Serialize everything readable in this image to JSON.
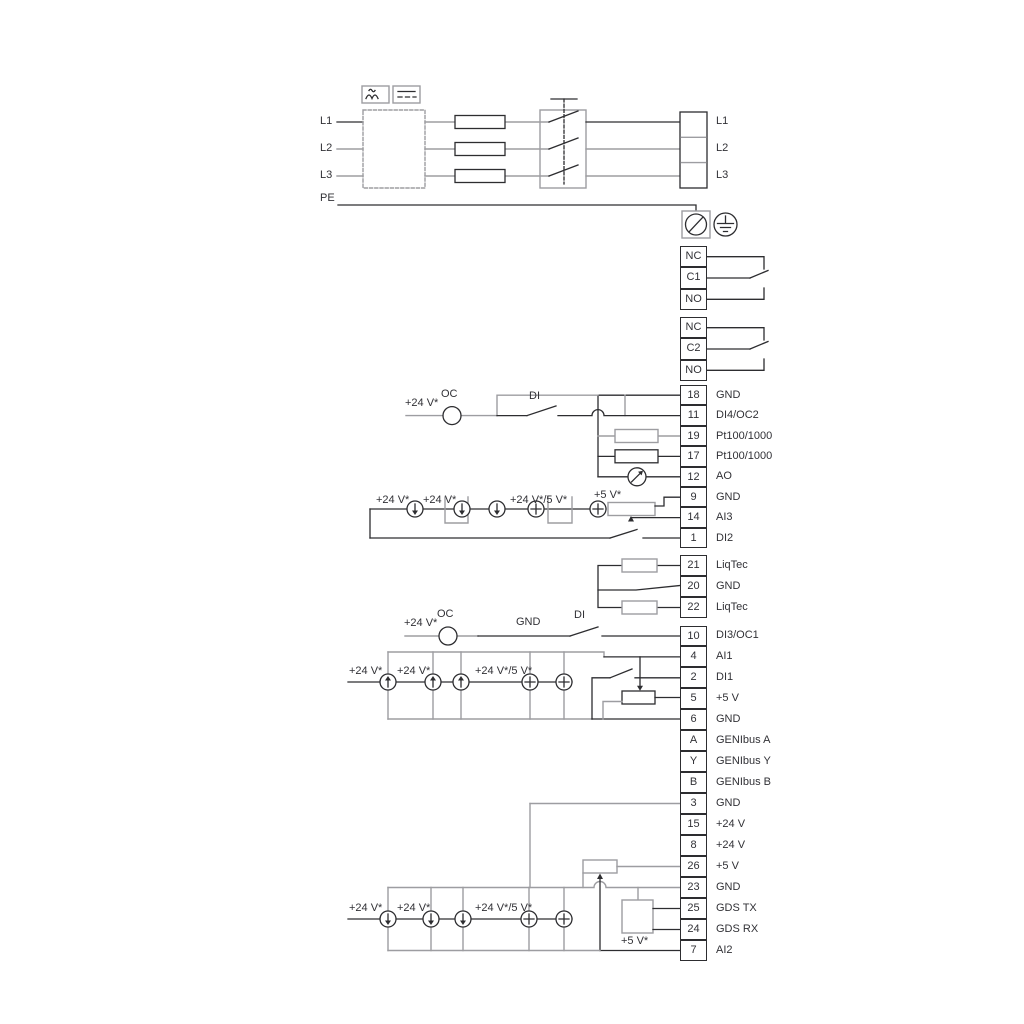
{
  "colors": {
    "line": "#2d2d30",
    "gray": "#9d9da1",
    "text": "#313136",
    "background": "#ffffff"
  },
  "mains": {
    "left": [
      "L1",
      "L2",
      "L3",
      "PE"
    ],
    "right": [
      "L1",
      "L2",
      "L3"
    ]
  },
  "terminal_strips": {
    "relay1": {
      "rows": [
        {
          "num": "NC"
        },
        {
          "num": "C1"
        },
        {
          "num": "NO"
        }
      ]
    },
    "relay2": {
      "rows": [
        {
          "num": "NC"
        },
        {
          "num": "C2"
        },
        {
          "num": "NO"
        }
      ]
    },
    "io_upper": {
      "rows": [
        {
          "num": "18",
          "label": "GND"
        },
        {
          "num": "11",
          "label": "DI4/OC2"
        },
        {
          "num": "19",
          "label": "Pt100/1000"
        },
        {
          "num": "17",
          "label": "Pt100/1000"
        },
        {
          "num": "12",
          "label": "AO"
        },
        {
          "num": "9",
          "label": "GND"
        },
        {
          "num": "14",
          "label": "AI3"
        },
        {
          "num": "1",
          "label": "DI2"
        }
      ]
    },
    "liqtec": {
      "rows": [
        {
          "num": "21",
          "label": "LiqTec"
        },
        {
          "num": "20",
          "label": "GND"
        },
        {
          "num": "22",
          "label": "LiqTec"
        }
      ]
    },
    "io_middle": {
      "rows": [
        {
          "num": "10",
          "label": "DI3/OC1"
        },
        {
          "num": "4",
          "label": "AI1"
        },
        {
          "num": "2",
          "label": "DI1"
        },
        {
          "num": "5",
          "label": "+5 V"
        },
        {
          "num": "6",
          "label": "GND"
        },
        {
          "num": "A",
          "label": "GENIbus A"
        },
        {
          "num": "Y",
          "label": "GENIbus Y"
        },
        {
          "num": "B",
          "label": "GENIbus B"
        }
      ]
    },
    "io_lower": {
      "rows": [
        {
          "num": "3",
          "label": "GND"
        },
        {
          "num": "15",
          "label": "+24 V"
        },
        {
          "num": "8",
          "label": "+24 V"
        },
        {
          "num": "26",
          "label": "+5 V"
        },
        {
          "num": "23",
          "label": "GND"
        },
        {
          "num": "25",
          "label": "GDS TX"
        },
        {
          "num": "24",
          "label": "GDS RX"
        },
        {
          "num": "7",
          "label": "AI2"
        }
      ]
    }
  },
  "annotations": {
    "upper_io": {
      "v24": "+24 V*",
      "oc": "OC",
      "di": "DI",
      "row_v24_a": "+24 V*",
      "row_v24_b": "+24 V*",
      "row_v24_5": "+24 V*/5 V*",
      "row_v5": "+5 V*"
    },
    "middle_io": {
      "v24": "+24 V*",
      "oc": "OC",
      "gnd": "GND",
      "di": "DI",
      "row_v24_a": "+24 V*",
      "row_v24_b": "+24 V*",
      "row_v24_5": "+24 V*/5 V*"
    },
    "lower_io": {
      "row_v24_a": "+24 V*",
      "row_v24_b": "+24 V*",
      "row_v24_5": "+24 V*/5 V*",
      "v5": "+5 V*"
    }
  }
}
